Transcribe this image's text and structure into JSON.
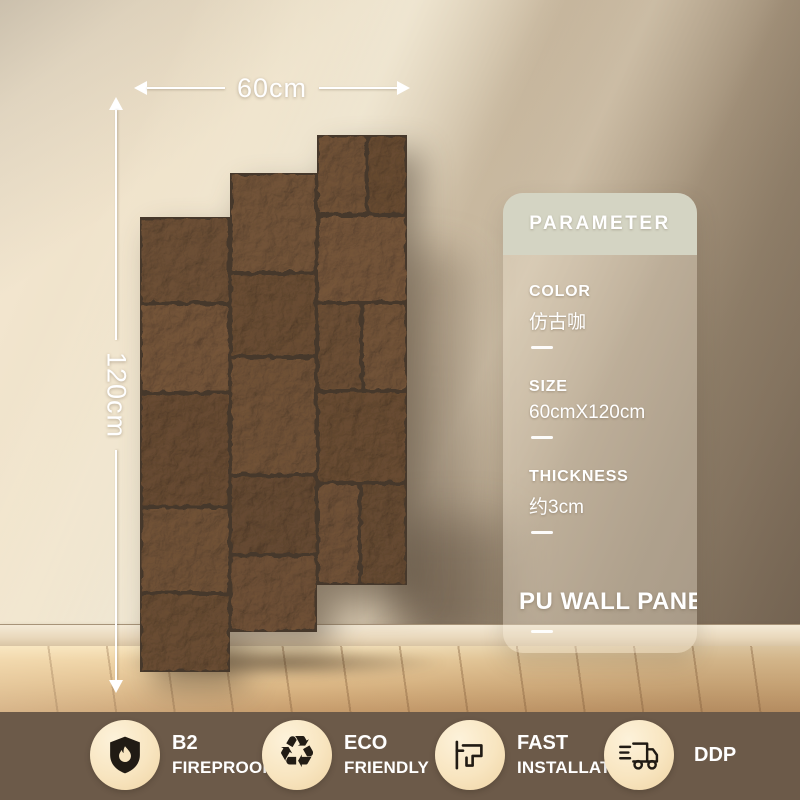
{
  "dimension_labels": {
    "width": "60cm",
    "height": "120cm"
  },
  "parameter_card": {
    "header": "PARAMETER",
    "items": [
      {
        "label": "COLOR",
        "value": "仿古咖"
      },
      {
        "label": "SIZE",
        "value": "60cmX120cm"
      },
      {
        "label": "THICKNESS",
        "value": "约3cm"
      }
    ],
    "product_title": "PU WALL PANEL"
  },
  "feature_badges": [
    {
      "icon": "shield-flame-icon",
      "line1": "B2",
      "line2": "FIREPROOF"
    },
    {
      "icon": "recycle-icon",
      "line1": "ECO",
      "line2": "FRIENDLY"
    },
    {
      "icon": "drill-icon",
      "line1": "FAST",
      "line2": "INSTALLATION"
    },
    {
      "icon": "delivery-truck-icon",
      "line1": "DDP"
    }
  ],
  "glyphs": {
    "recycle": "♻"
  },
  "colors": {
    "bottom_bar": "#6c5a49",
    "badge_circle": "#f8e5c0",
    "card_header": "#d4d4c3",
    "stone_base": "#6b5544",
    "wall_dark": "#877562",
    "wall_light": "#f6ead4",
    "floor_wood": "#dcb886"
  }
}
